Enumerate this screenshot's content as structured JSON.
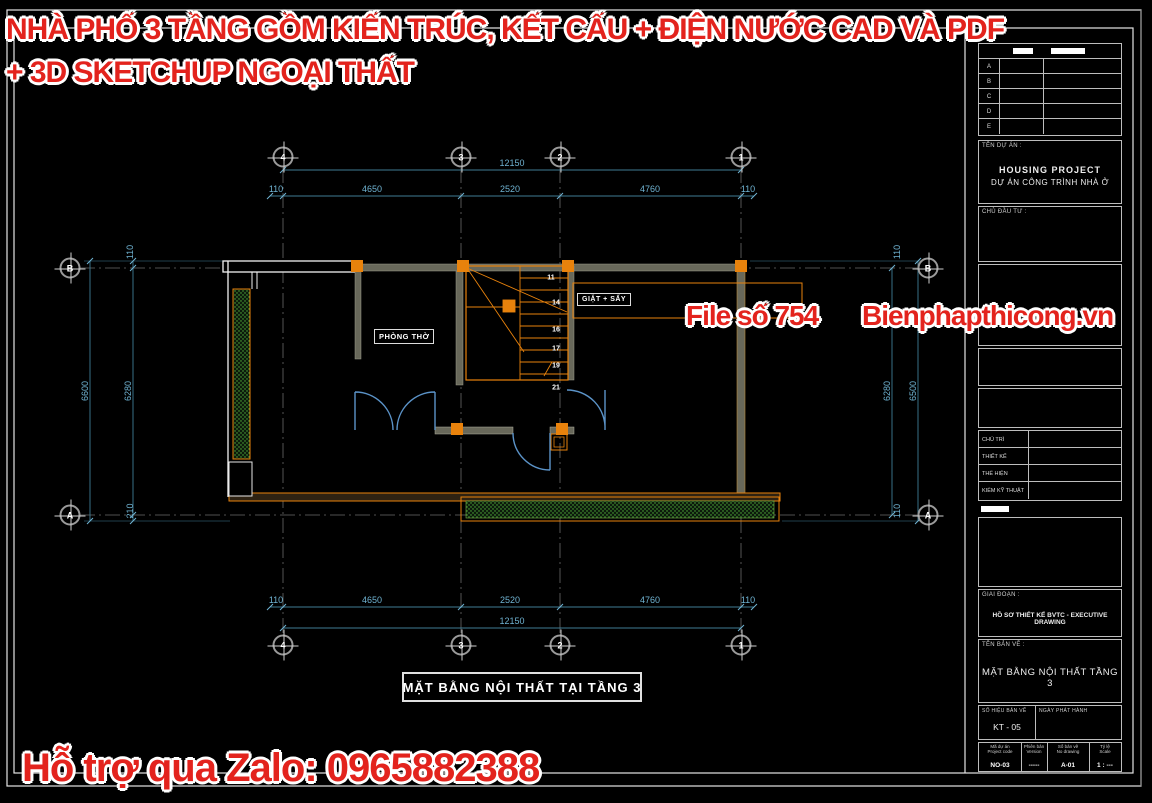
{
  "colors": {
    "accent_red": "#e3231d",
    "dim_blue": "#6fb3d2",
    "wall_orange": "#e8820c",
    "hatch_green": "#55b53c"
  },
  "watermark": {
    "title_line1": "NHÀ PHỐ 3 TẦNG GỒM KIẾN TRÚC, KẾT CẤU + ĐIỆN NƯỚC CAD VÀ PDF",
    "title_line2": "+ 3D SKETCHUP NGOẠI THẤT",
    "file_no": "File số 754",
    "site": "Bienphapthicong.vn",
    "zalo": "Hỗ trợ qua Zalo: 0965882388"
  },
  "plan": {
    "caption": "MẶT BẰNG NỘI THẤT TẠI TẦNG 3",
    "rooms": {
      "phong_tho": "PHÒNG THỜ",
      "giat_say": "GIẶT + SẤY"
    },
    "grid": {
      "cols": [
        "4",
        "3",
        "2",
        "1"
      ],
      "rows": [
        "B",
        "A"
      ]
    },
    "dims": {
      "top_total": "12150",
      "bot_total": "12150",
      "top_segs": [
        "110",
        "4650",
        "2520",
        "4760",
        "110"
      ],
      "bot_segs": [
        "110",
        "4650",
        "2520",
        "4760",
        "110"
      ],
      "left_top": "110",
      "left_outer": "6600",
      "left_inner": "6280",
      "left_bottom": "210",
      "right_top": "110",
      "right_inner": "6280",
      "right_outer": "6500",
      "right_bottom": "110"
    },
    "stairs": {
      "steps": [
        "11",
        "14",
        "16",
        "17",
        "19",
        "21"
      ]
    }
  },
  "titleblock": {
    "revision": {
      "rows": [
        "A",
        "B",
        "C",
        "D",
        "E"
      ]
    },
    "project": {
      "label": "TÊN DỰ ÁN :",
      "line1": "HOUSING PROJECT",
      "line2": "DỰ ÁN CÔNG TRÌNH NHÀ Ở"
    },
    "investor": {
      "label": "CHỦ ĐẦU TƯ :"
    },
    "staff": {
      "rows": [
        "CHỦ TRÌ",
        "THIẾT KẾ",
        "THỂ HIỆN",
        "KIỂM KỸ THUẬT"
      ]
    },
    "phase": {
      "label": "GIAI ĐOẠN :",
      "value": "HỒ SƠ THIẾT KẾ BVTC - EXECUTIVE DRAWING"
    },
    "drawing": {
      "label": "TÊN BẢN VẼ :",
      "value": "MẶT BẰNG NỘI THẤT TẦNG 3"
    },
    "number": {
      "label": "SỐ HIỆU BẢN VẼ",
      "value": "KT - 05"
    },
    "issue": {
      "label": "NGÀY PHÁT HÀNH",
      "value": ""
    },
    "footer": {
      "cells": [
        {
          "l1": "Mã dự án",
          "l2": "Project code",
          "value": "NO-03"
        },
        {
          "l1": "Phiên bản",
          "l2": "Version",
          "value": "-----"
        },
        {
          "l1": "Số bản vẽ",
          "l2": "No drawing",
          "value": "A-01"
        },
        {
          "l1": "Tỷ lệ",
          "l2": "Scale",
          "value": "1 : ---"
        }
      ]
    }
  }
}
